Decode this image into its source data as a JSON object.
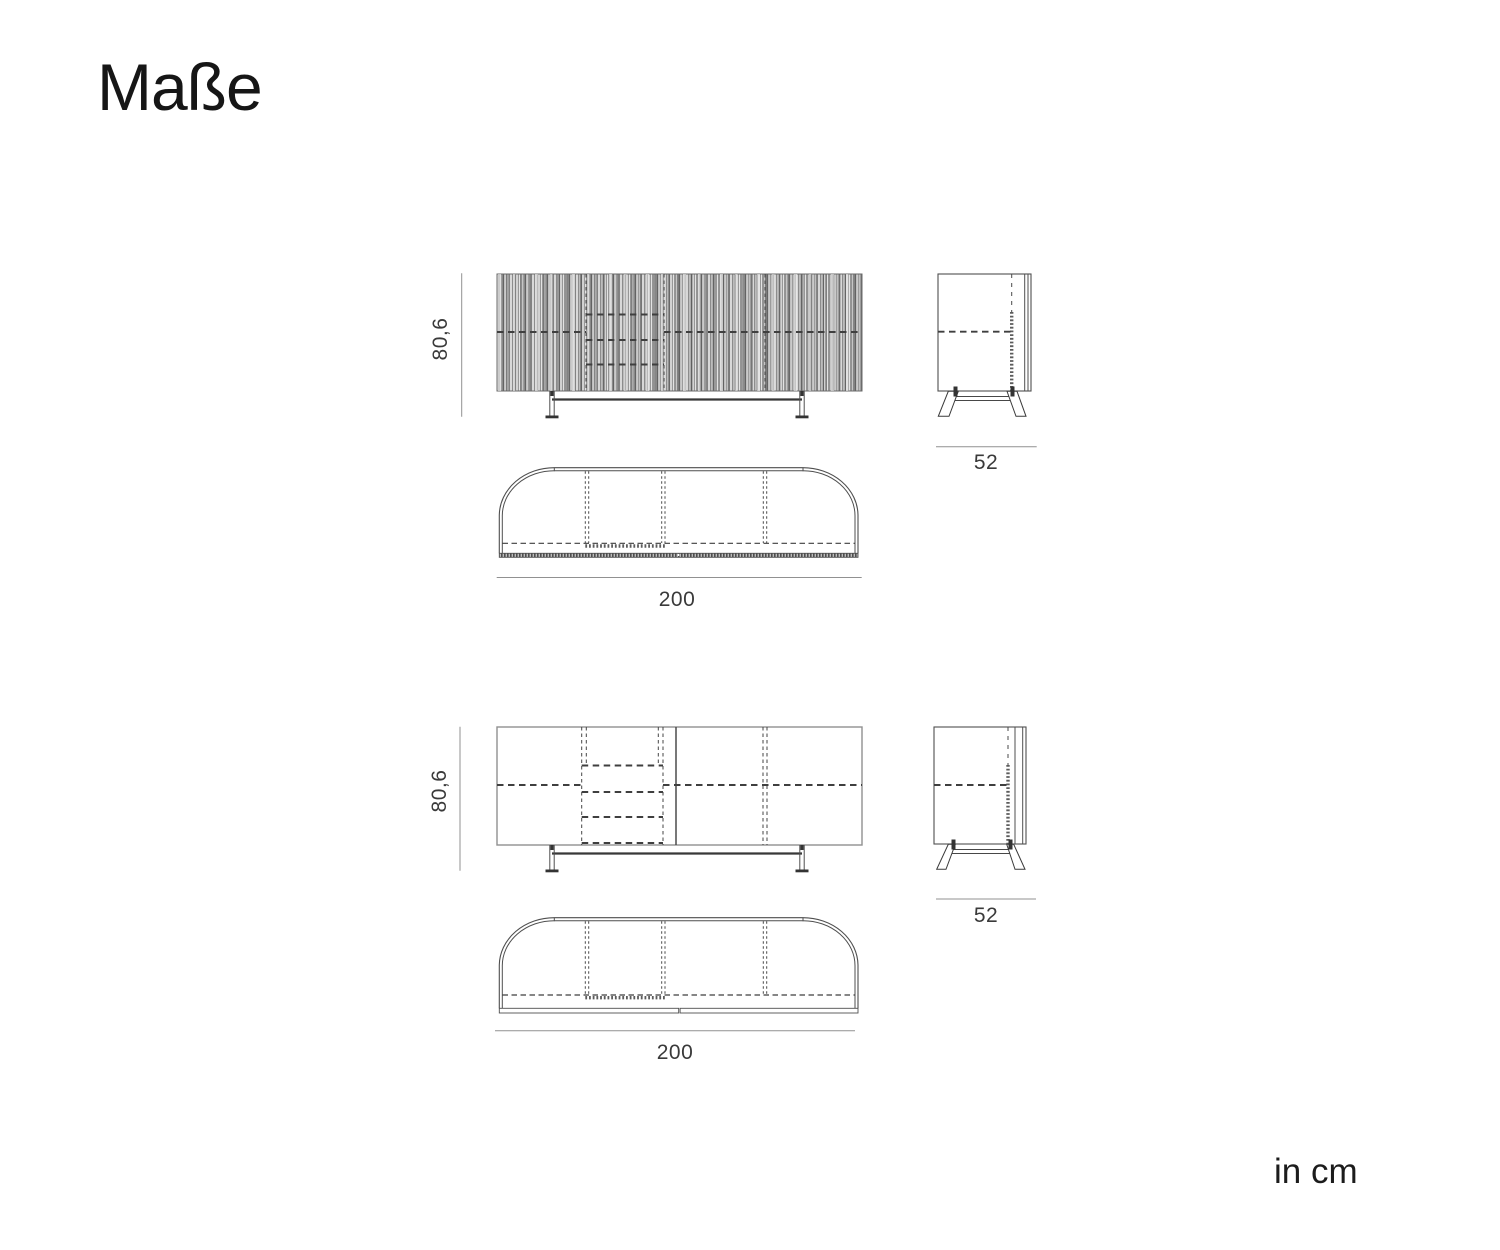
{
  "title": "Maße",
  "units_note": "in cm",
  "views": {
    "fluted_sideboard": {
      "front": {
        "height_label": "80,6"
      },
      "side": {
        "depth_label": "52"
      },
      "top": {
        "width_label": "200"
      }
    },
    "plain_sideboard": {
      "front": {
        "height_label": "80,6"
      },
      "side": {
        "depth_label": "52"
      },
      "top": {
        "width_label": "200"
      }
    }
  }
}
